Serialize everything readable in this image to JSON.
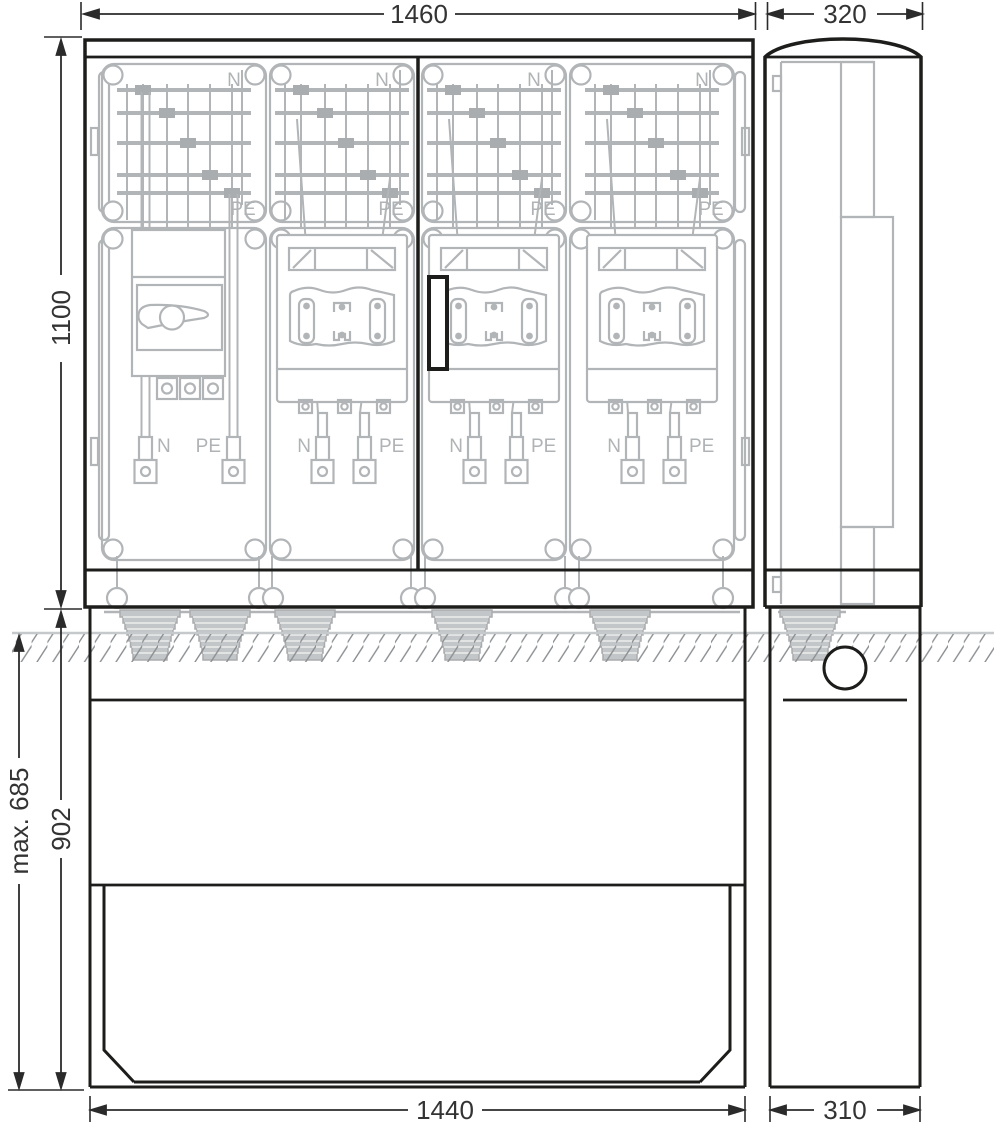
{
  "drawing_title": "Cable distribution cabinet dimension drawing (front and side view)",
  "dimensions": {
    "front_width_top": "1460",
    "side_depth_top": "320",
    "cabinet_height": "1100",
    "max_buried_depth": "max. 685",
    "base_height": "902",
    "front_width_bottom": "1440",
    "side_depth_bottom": "310"
  },
  "conductor_labels": {
    "neutral": "N",
    "protective_earth": "PE"
  },
  "colors": {
    "outline": "#1d1d1b",
    "interior_gray": "#b2b5b7",
    "square_clamp_gray": "#aaadaf",
    "gland_fill": "#c3c6c8",
    "hatch": "#8b8f92",
    "ground_line": "#c6c9cb",
    "dimension_text": "#333333"
  }
}
